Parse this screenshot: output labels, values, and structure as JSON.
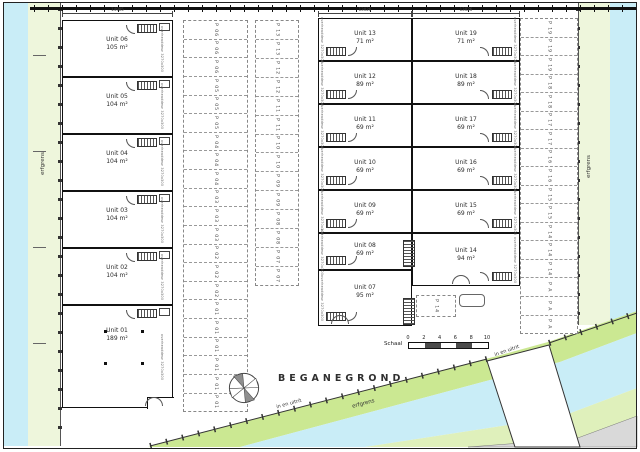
{
  "title": "BEGANEGROND",
  "labels": {
    "erfgrens": "erfgrens",
    "in_en_uitrit": "in en uitrit",
    "door_spec": "overheaddeur 3270x3000mm",
    "parking_prefix": "P"
  },
  "dimensions": {
    "left_building": "14905",
    "right_building_left": "13026",
    "right_building_right": "13026"
  },
  "scale_bar": {
    "label": "Schaal",
    "ticks": [
      "0",
      "2",
      "4",
      "6",
      "8",
      "10"
    ]
  },
  "left_building_units": [
    {
      "name": "Unit 06",
      "area": "105 m²"
    },
    {
      "name": "Unit 05",
      "area": "104 m²"
    },
    {
      "name": "Unit 04",
      "area": "104 m²"
    },
    {
      "name": "Unit 03",
      "area": "104 m²"
    },
    {
      "name": "Unit 02",
      "area": "104 m²"
    },
    {
      "name": "Unit 01",
      "area": "189 m²"
    }
  ],
  "right_building_left_units": [
    {
      "name": "Unit 13",
      "area": "71 m²"
    },
    {
      "name": "Unit 12",
      "area": "89 m²"
    },
    {
      "name": "Unit 11",
      "area": "69 m²"
    },
    {
      "name": "Unit 10",
      "area": "69 m²"
    },
    {
      "name": "Unit 09",
      "area": "69 m²"
    },
    {
      "name": "Unit 08",
      "area": "69 m²"
    },
    {
      "name": "Unit 07",
      "area": "95 m²"
    }
  ],
  "right_building_right_units": [
    {
      "name": "Unit 19",
      "area": "71 m²"
    },
    {
      "name": "Unit 18",
      "area": "89 m²"
    },
    {
      "name": "Unit 17",
      "area": "69 m²"
    },
    {
      "name": "Unit 16",
      "area": "69 m²"
    },
    {
      "name": "Unit 15",
      "area": "69 m²"
    },
    {
      "name": "Unit 14",
      "area": "94 m²"
    }
  ],
  "parking": {
    "strip_a": [
      "06",
      "06",
      "06",
      "05",
      "05",
      "05",
      "04",
      "04",
      "04",
      "03",
      "03",
      "03",
      "02",
      "02",
      "02",
      "01",
      "01",
      "01",
      "01",
      "01",
      "01"
    ],
    "strip_b": [
      "13",
      "13",
      "12",
      "12",
      "11",
      "11",
      "10",
      "10",
      "09",
      "09",
      "08",
      "08",
      "07",
      "07"
    ],
    "strip_right": [
      "19",
      "19",
      "19",
      "18",
      "18",
      "17",
      "17",
      "16",
      "16",
      "15",
      "15",
      "14",
      "14",
      "14",
      "A",
      "A",
      "A"
    ],
    "extra_stall": "14"
  },
  "colors": {
    "water": "#c9edf7",
    "green_edge": "#eef6dc",
    "green_band": "#cbe892",
    "green_band_outer": "#dff0bb",
    "gray_area": "#d9d9d9",
    "scale_dark": "#4a4a4a"
  }
}
